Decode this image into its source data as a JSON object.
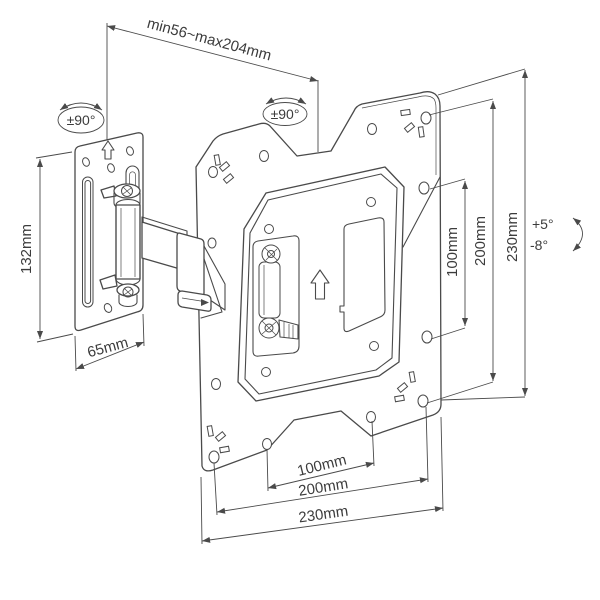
{
  "drawing": {
    "background_color": "#ffffff",
    "line_color": "#4a4a4a",
    "text_color": "#3c3c3c",
    "labels": {
      "extension_range": "min56~max204mm",
      "swivel_left": "±90°",
      "swivel_right": "±90°",
      "wall_plate_height": "132mm",
      "wall_plate_width": "65mm",
      "vesa_height_100": "100mm",
      "vesa_height_200": "200mm",
      "plate_height_230": "230mm",
      "vesa_width_100": "100mm",
      "vesa_width_200": "200mm",
      "plate_width_230": "230mm",
      "tilt_up": "+5°",
      "tilt_down": "-8°"
    }
  }
}
